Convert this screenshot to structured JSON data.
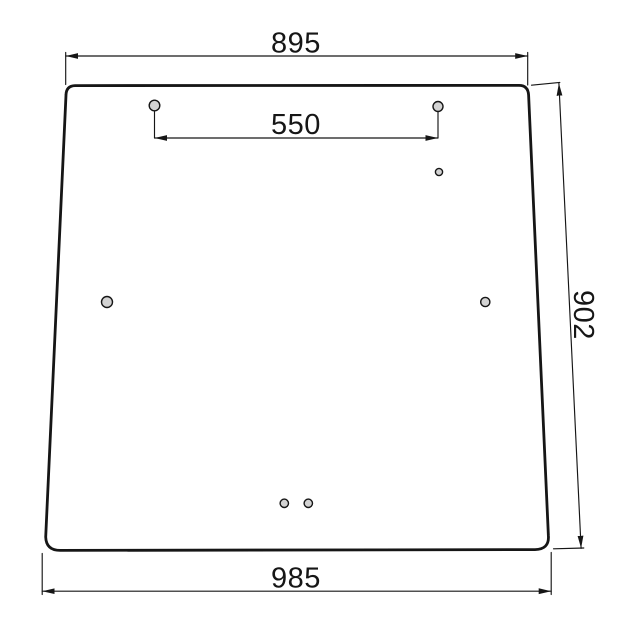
{
  "drawing": {
    "labels": {
      "top_width": "895",
      "hole_spacing": "550",
      "height": "902",
      "bottom_width": "985"
    },
    "holes": [
      {
        "id": "top-left",
        "cx": 154.5,
        "cy": 105.5,
        "r": 5.3
      },
      {
        "id": "top-right",
        "cx": 438.0,
        "cy": 106.5,
        "r": 5.0
      },
      {
        "id": "upper-right-small",
        "cx": 439.0,
        "cy": 172.0,
        "r": 3.6
      },
      {
        "id": "middle-left",
        "cx": 107.0,
        "cy": 302.0,
        "r": 5.5
      },
      {
        "id": "middle-right",
        "cx": 485.3,
        "cy": 302.0,
        "r": 4.6
      },
      {
        "id": "bottom-center-left",
        "cx": 284.3,
        "cy": 503.3,
        "r": 4.2
      },
      {
        "id": "bottom-center-right",
        "cx": 308.3,
        "cy": 503.3,
        "r": 4.2
      }
    ],
    "colors": {
      "line": "#161616",
      "hole_fill": "#d3d3d3",
      "background": "#ffffff"
    }
  }
}
